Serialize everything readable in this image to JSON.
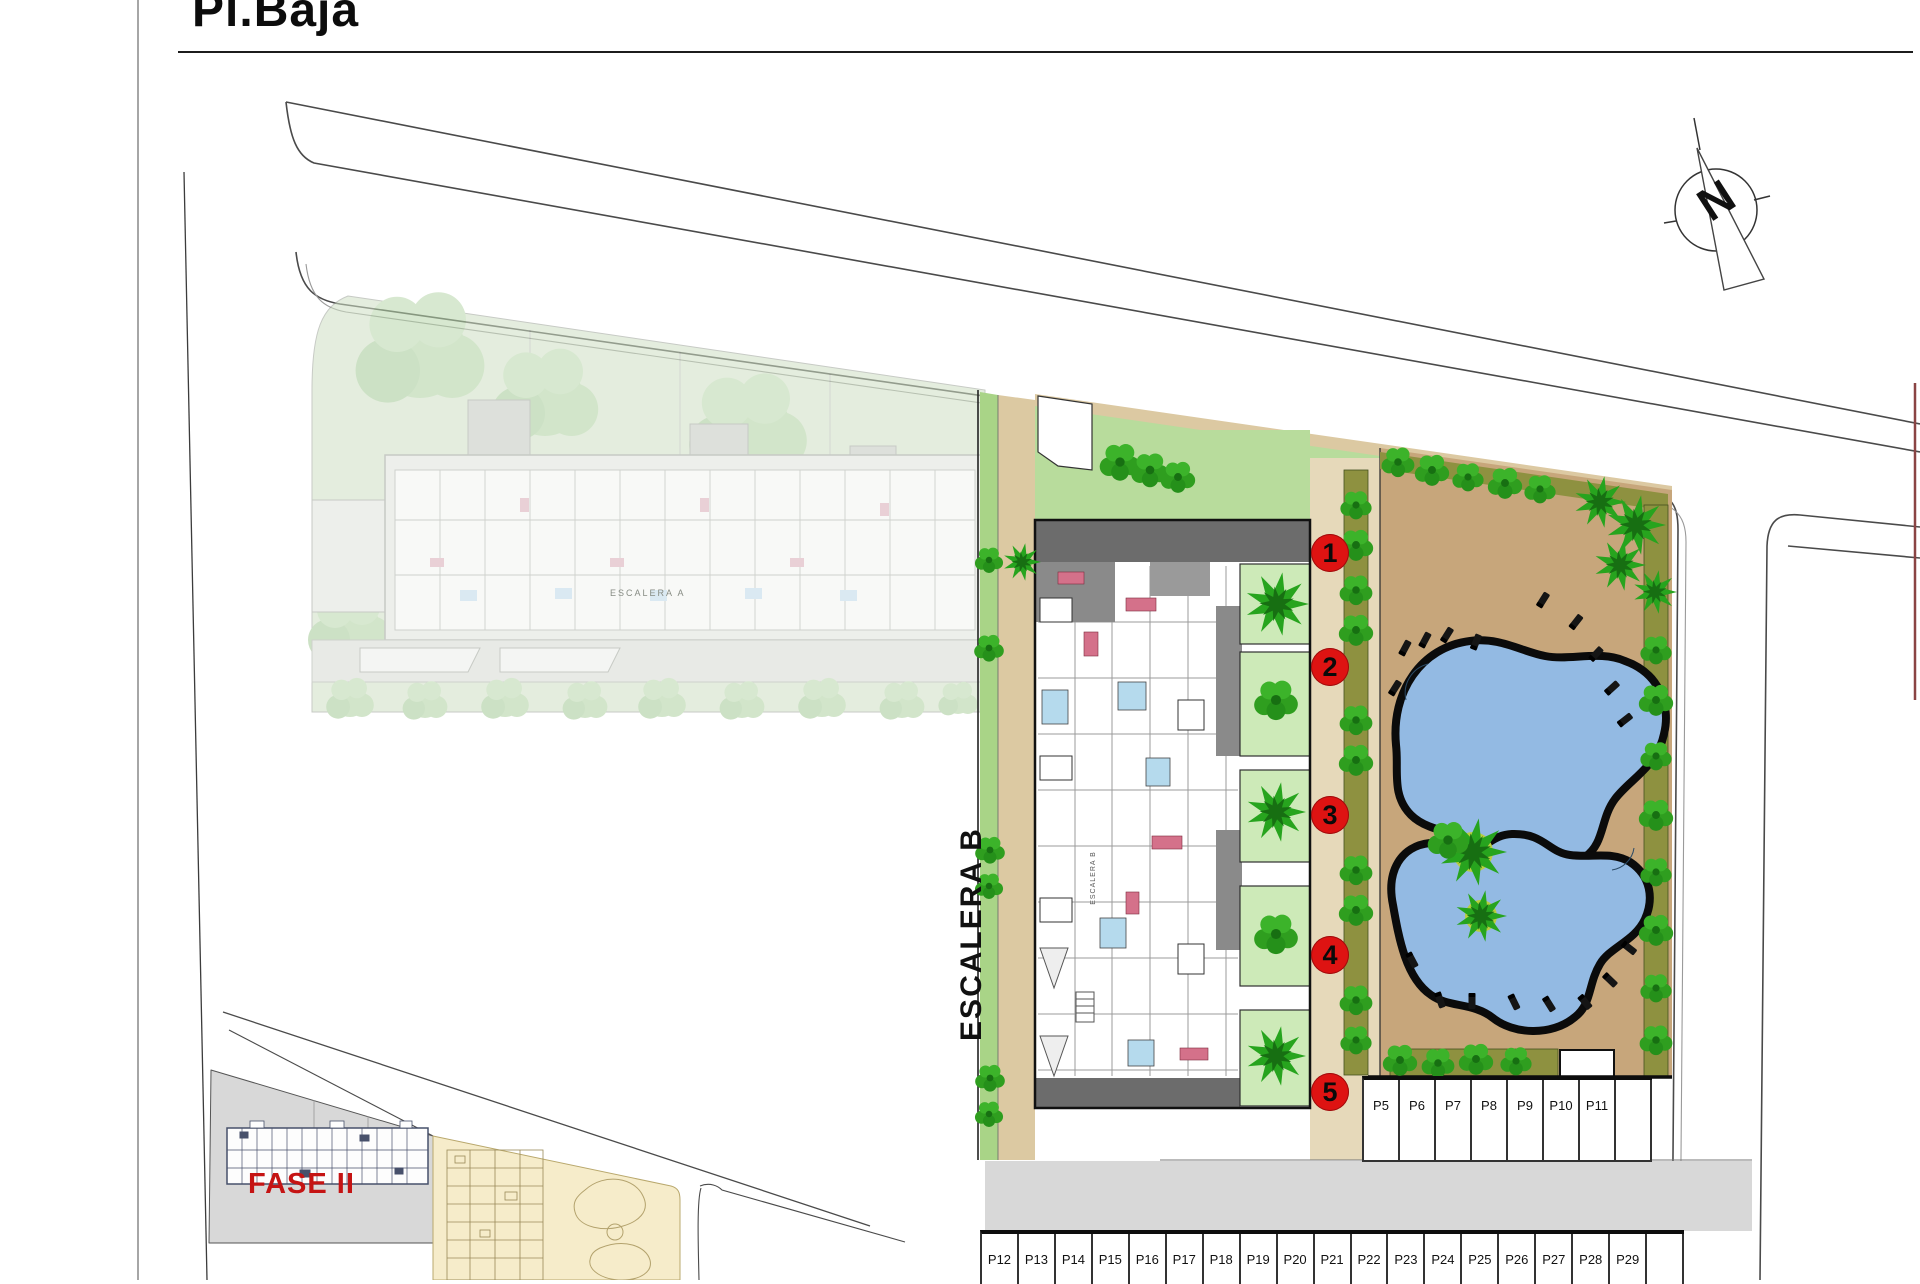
{
  "header": {
    "title": "Pl.Baja"
  },
  "labels": {
    "stair_b": "ESCALERA B",
    "stair_b_small": "ESCALERA B",
    "stair_a": "ESCALERA A",
    "phase": "FASE II",
    "compass_letter": "N"
  },
  "unit_markers": [
    "1",
    "2",
    "3",
    "4",
    "5"
  ],
  "parking": {
    "right_row": [
      "P5",
      "P6",
      "P7",
      "P8",
      "P9",
      "P10",
      "P11",
      ""
    ],
    "bottom_row": [
      "P12",
      "P13",
      "P14",
      "P15",
      "P16",
      "P17",
      "P18",
      "P19",
      "P20",
      "P21",
      "P22",
      "P23",
      "P24",
      "P25",
      "P26",
      "P27",
      "P28",
      "P29",
      ""
    ]
  },
  "colors": {
    "marker_red": "#de1312",
    "phase_red": "#c51414",
    "pool_blue": "#93bae3",
    "deck_tan": "#c7a67b",
    "walk_tan": "#dcc9a2",
    "garden_green": "#b8dc9c",
    "terrace_green": "#cdeab8",
    "strip_green": "#a9d487",
    "hedge_olive": "#8e9140",
    "tree_green": "#27a41e",
    "wall_gray": "#6c6c6c",
    "faded_sage": "#cfe0c4",
    "keyplan_gray": "#d8d8d8",
    "keyplan_cream": "#f6ecca"
  }
}
